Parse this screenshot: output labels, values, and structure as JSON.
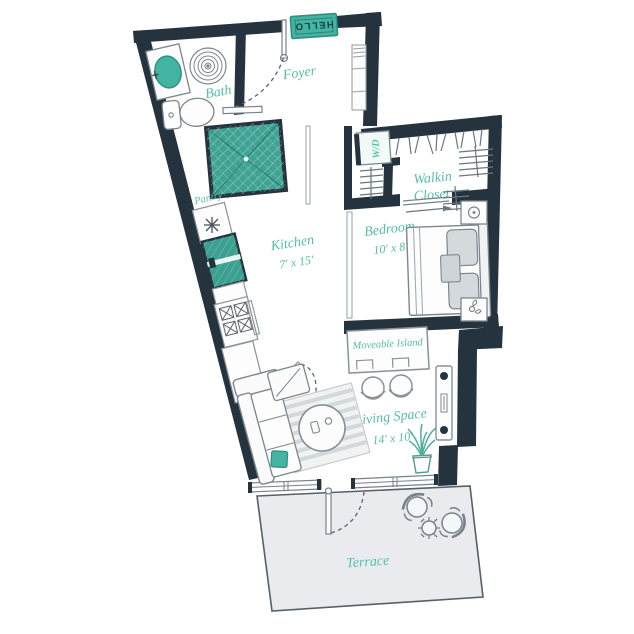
{
  "meta": {
    "type": "apartment-floor-plan",
    "style": "studio with terrace"
  },
  "colors": {
    "wall": "#24333e",
    "teal": "#43b3a2",
    "teal_dark": "#2b9183",
    "label_teal": "#56bdac",
    "furniture_line": "#7d868d",
    "terrace_floor": "#e9ebee"
  },
  "labels": {
    "foyer": "Foyer",
    "bath": "Bath",
    "wd": "W/D",
    "walkin_line1": "Walkin",
    "walkin_line2": "Closet",
    "pantry": "Pantry",
    "kitchen": "Kitchen",
    "kitchen_dims": "7' x 15'",
    "bedroom": "Bedroom",
    "bedroom_dims": "10' x 8'",
    "island": "Moveable Island",
    "living": "Living Space",
    "living_dims": "14' x 10'",
    "terrace": "Terrace",
    "doormat": "HELLO"
  },
  "rooms": [
    {
      "name": "Foyer"
    },
    {
      "name": "Bath"
    },
    {
      "name": "Walkin Closet"
    },
    {
      "name": "Kitchen",
      "dims": "7' x 15'"
    },
    {
      "name": "Bedroom",
      "dims": "10' x 8'"
    },
    {
      "name": "Living Space",
      "dims": "14' x 10'"
    },
    {
      "name": "Terrace"
    }
  ],
  "fixtures": [
    "doormat",
    "entry-door",
    "shower",
    "toilet",
    "vanity-sink",
    "spiral-rug",
    "foyer-cabinet",
    "washer-dryer",
    "closet-rods",
    "closet-shelves",
    "refrigerator",
    "stove",
    "pantry-light",
    "kitchen-counter",
    "bed",
    "nightstand-lamp",
    "nightstand-plant",
    "sliding-door",
    "moveable-island",
    "bar-stools",
    "sofa",
    "chaise",
    "rug",
    "coffee-table",
    "potted-plant",
    "window-strip",
    "terrace-door",
    "terrace-chairs",
    "terrace-table"
  ]
}
